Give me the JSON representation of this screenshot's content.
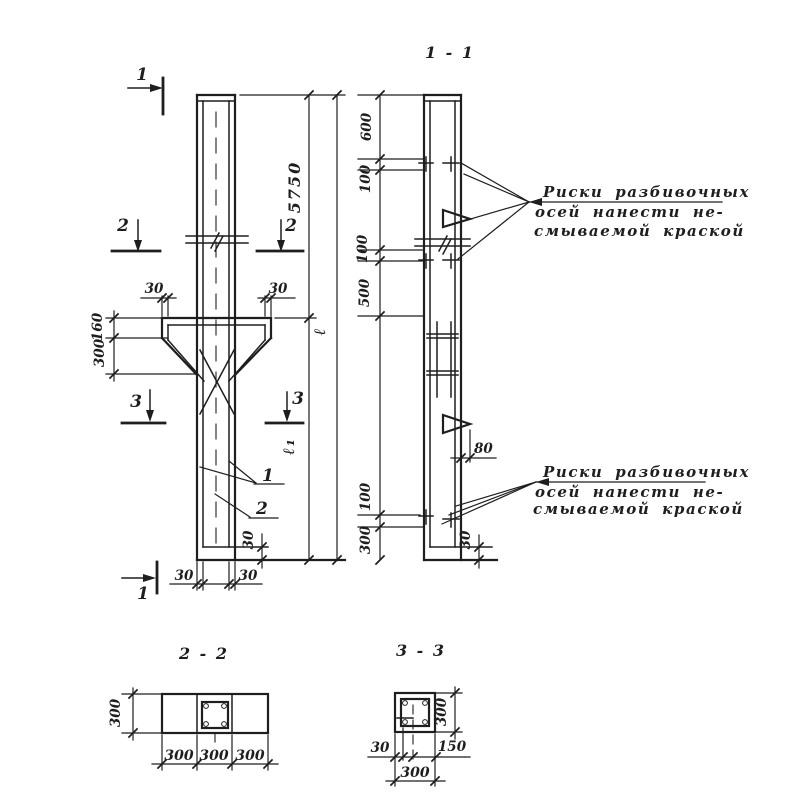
{
  "titles": {
    "s11": "1 - 1",
    "s22": "2 - 2",
    "s33": "3 - 3"
  },
  "marks": {
    "m1": "1",
    "m2": "2",
    "m3": "3"
  },
  "callouts": {
    "c1": "1",
    "c2": "2"
  },
  "dims": {
    "d30": "30",
    "d80": "80",
    "d100": "100",
    "d150": "150",
    "d160": "160",
    "d300": "300",
    "d500": "500",
    "d600": "600",
    "d5750": "5750",
    "total": "ℓ",
    "lower": "ℓ₁"
  },
  "notes": {
    "top": {
      "l1": "Риски разбивочных",
      "l2": "осей нанести не-",
      "l3": "смываемой краской"
    },
    "bottom": {
      "l1": "Риски разбивочных",
      "l2": "осей нанести не-",
      "l3": "смываемой краской"
    }
  },
  "colors": {
    "ink": "#1e1e1e",
    "paper": "#ffffff"
  }
}
